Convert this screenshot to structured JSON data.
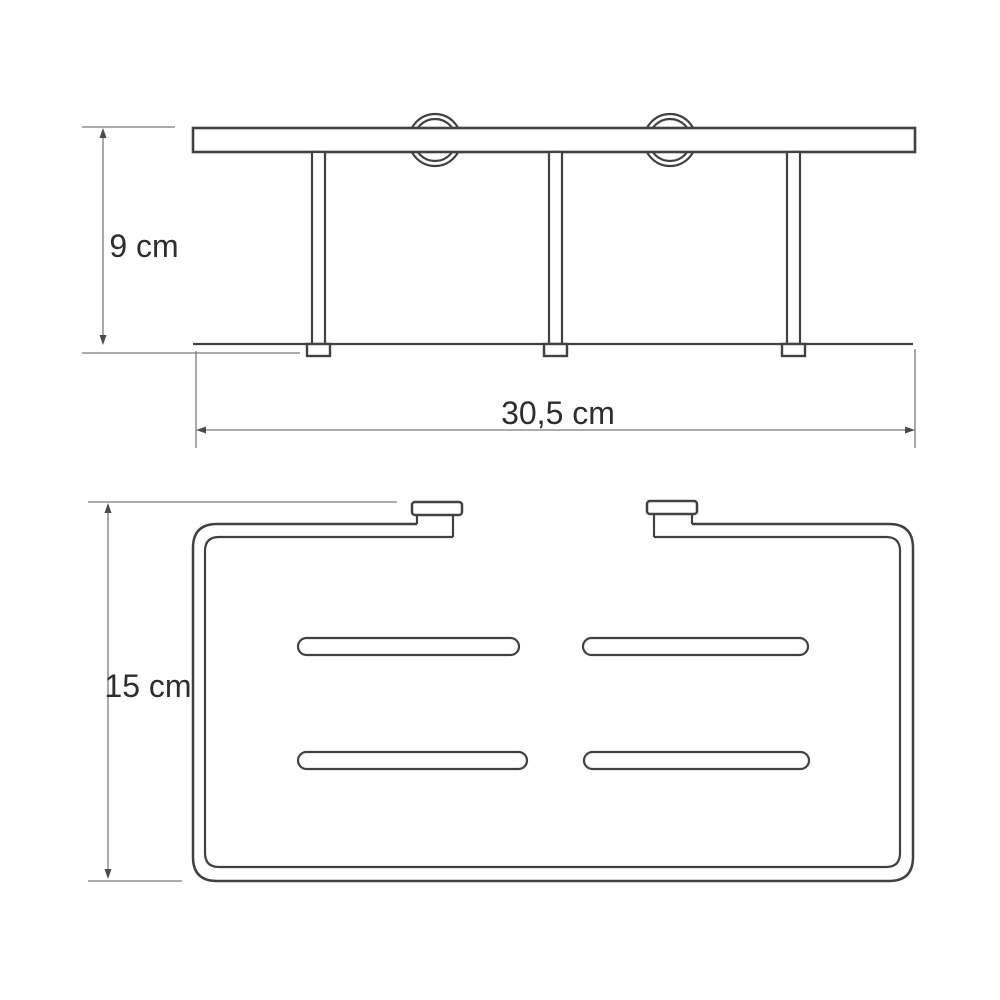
{
  "page": {
    "background": "#ffffff",
    "content_type": "product technical drawing"
  },
  "drawing": {
    "labels": {
      "height": "9 cm",
      "width": "30,5 cm",
      "depth": "15 cm"
    },
    "views": [
      {
        "id": "front-view",
        "description": "front elevation: wall bar with two mounting rings, three legs with feet, bottom rail",
        "dimensions": [
          {
            "label": "9 cm",
            "value": 9,
            "unit": "cm",
            "orientation": "vertical"
          },
          {
            "label": "30,5 cm",
            "value": 30.5,
            "unit": "cm",
            "orientation": "horizontal"
          }
        ]
      },
      {
        "id": "top-view",
        "description": "top view: rounded basket rim with two wall-mount tabs and four drain slots",
        "dimensions": [
          {
            "label": "15 cm",
            "value": 15,
            "unit": "cm",
            "orientation": "vertical"
          }
        ]
      }
    ],
    "colors": {
      "object_line": "#414141",
      "dimension_line": "#7b7b7b",
      "text": "#2e2e2e",
      "background": "#ffffff"
    }
  }
}
